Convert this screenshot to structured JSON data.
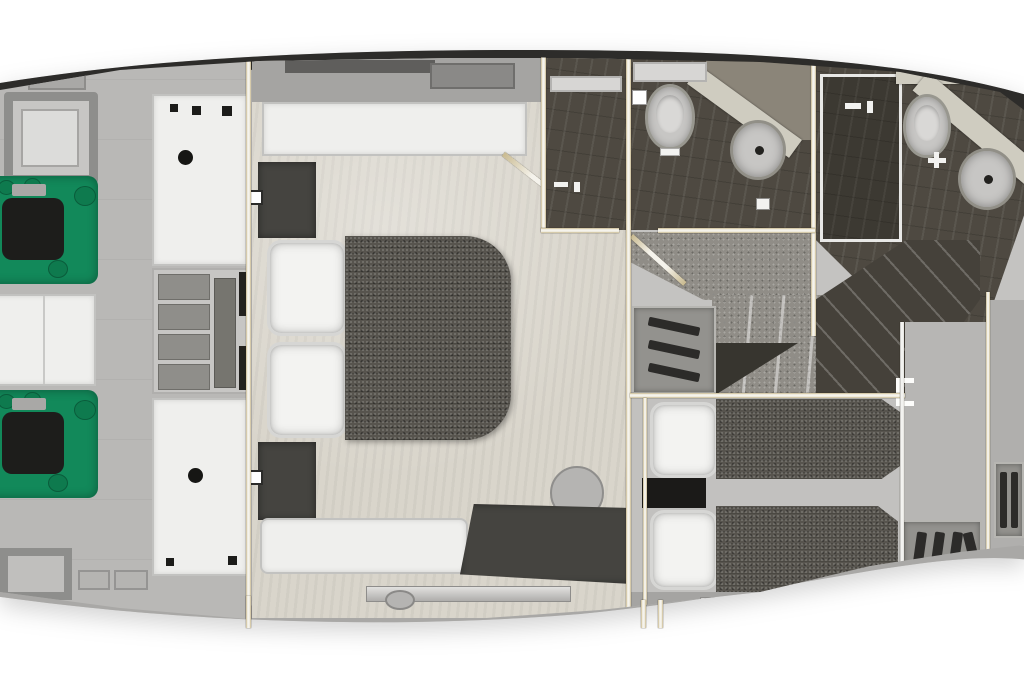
{
  "meta": {
    "subject": "yacht-lower-deck-floor-plan",
    "view": "top-down-3d-render",
    "text_on_screen": ""
  },
  "palette": {
    "background": "#ffffff",
    "hull_edge": "#2d2c2a",
    "hull_fill": "#c4c3c1",
    "hull_bottom_band": "#a9a8a6",
    "engine_room_floor": "#b9b8b6",
    "master_floor": "#d9d5cb",
    "bathroom_floor": "#4e4941",
    "carpet": "#908d87",
    "bed_fabric": "#57544e",
    "pillow": "#f3f3f1",
    "engine_green": "#12895a",
    "engine_block": "#1d1d1b",
    "furniture_white": "#efefed",
    "furniture_dark": "#454440",
    "wall_tan": "#c9ba90",
    "wall_white": "#f5f3ec",
    "counter": "#cfccc0",
    "fixture_gray": "#c7c6c4",
    "stairwell_dark": "#45413a"
  },
  "rooms": [
    {
      "id": "engine-room",
      "label": "engine room (aft)"
    },
    {
      "id": "master-cabin",
      "label": "master cabin with double bed"
    },
    {
      "id": "master-shower-room",
      "label": "master shower room"
    },
    {
      "id": "master-wc-room",
      "label": "master bathroom (toilet + sink)"
    },
    {
      "id": "forward-bathroom",
      "label": "forward bathroom (shower, toilet, sink)"
    },
    {
      "id": "stair-lobby",
      "label": "carpeted lobby and staircase"
    },
    {
      "id": "guest-cabin",
      "label": "guest cabin with twin beds"
    },
    {
      "id": "forward-landing",
      "label": "forward landing corridor"
    }
  ],
  "fixtures": [
    {
      "name": "engine-port",
      "room": "engine-room"
    },
    {
      "name": "engine-starboard",
      "room": "engine-room"
    },
    {
      "name": "deck-hatch",
      "room": "engine-room",
      "count": 2
    },
    {
      "name": "storage-cabinet-white",
      "room": "engine-room",
      "count": 3
    },
    {
      "name": "shelf-unit",
      "room": "engine-room"
    },
    {
      "name": "credenza",
      "room": "master-cabin"
    },
    {
      "name": "wardrobe",
      "room": "master-cabin",
      "count": 2
    },
    {
      "name": "double-bed",
      "room": "master-cabin"
    },
    {
      "name": "bench-seat",
      "room": "master-cabin"
    },
    {
      "name": "vanity-desk",
      "room": "master-cabin"
    },
    {
      "name": "stool",
      "room": "master-cabin"
    },
    {
      "name": "toilet",
      "room": "master-wc-room"
    },
    {
      "name": "round-sink",
      "room": "master-wc-room"
    },
    {
      "name": "shower",
      "room": "master-shower-room"
    },
    {
      "name": "shower",
      "room": "forward-bathroom"
    },
    {
      "name": "toilet",
      "room": "forward-bathroom"
    },
    {
      "name": "round-sink",
      "room": "forward-bathroom"
    },
    {
      "name": "staircase",
      "room": "stair-lobby"
    },
    {
      "name": "louvered-cabinet",
      "room": "stair-lobby"
    },
    {
      "name": "single-bed",
      "room": "guest-cabin",
      "count": 2
    },
    {
      "name": "nightstand",
      "room": "guest-cabin"
    },
    {
      "name": "louvered-locker",
      "room": "forward-landing",
      "count": 2
    }
  ]
}
